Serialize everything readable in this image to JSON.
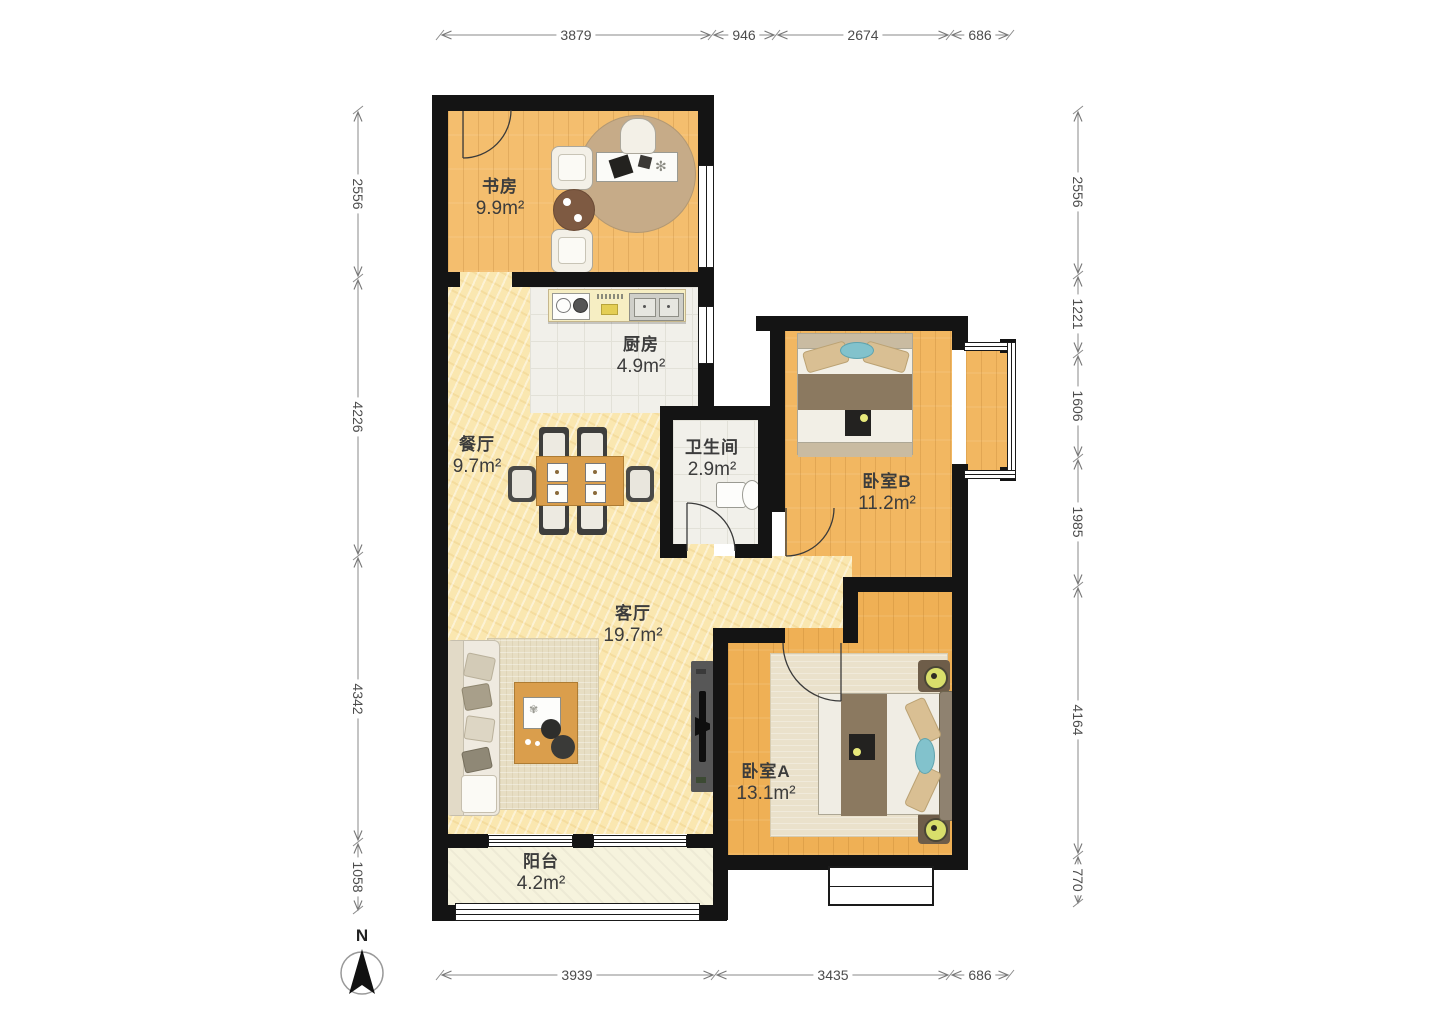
{
  "rooms": {
    "study": {
      "name": "书房",
      "area": "9.9m²"
    },
    "kitchen": {
      "name": "厨房",
      "area": "4.9m²"
    },
    "dining": {
      "name": "餐厅",
      "area": "9.7m²"
    },
    "bathroom": {
      "name": "卫生间",
      "area": "2.9m²"
    },
    "bedroom_b": {
      "name": "卧室B",
      "area": "11.2m²"
    },
    "living": {
      "name": "客厅",
      "area": "19.7m²"
    },
    "bedroom_a": {
      "name": "卧室A",
      "area": "13.1m²"
    },
    "balcony": {
      "name": "阳台",
      "area": "4.2m²"
    }
  },
  "dimensions": {
    "top": [
      "3879",
      "946",
      "2674",
      "686"
    ],
    "left": [
      "2556",
      "4226",
      "4342",
      "1058"
    ],
    "right": [
      "2556",
      "1221",
      "1606",
      "1985",
      "4164",
      "770"
    ],
    "bottom": [
      "3939",
      "3435",
      "686"
    ]
  },
  "compass": {
    "label": "N"
  },
  "colors": {
    "wall": "#141414",
    "wood": "#F2B761",
    "marble": "#FAE7B0",
    "tile": "#F1F0EA",
    "balcony": "#F6F3DD"
  }
}
